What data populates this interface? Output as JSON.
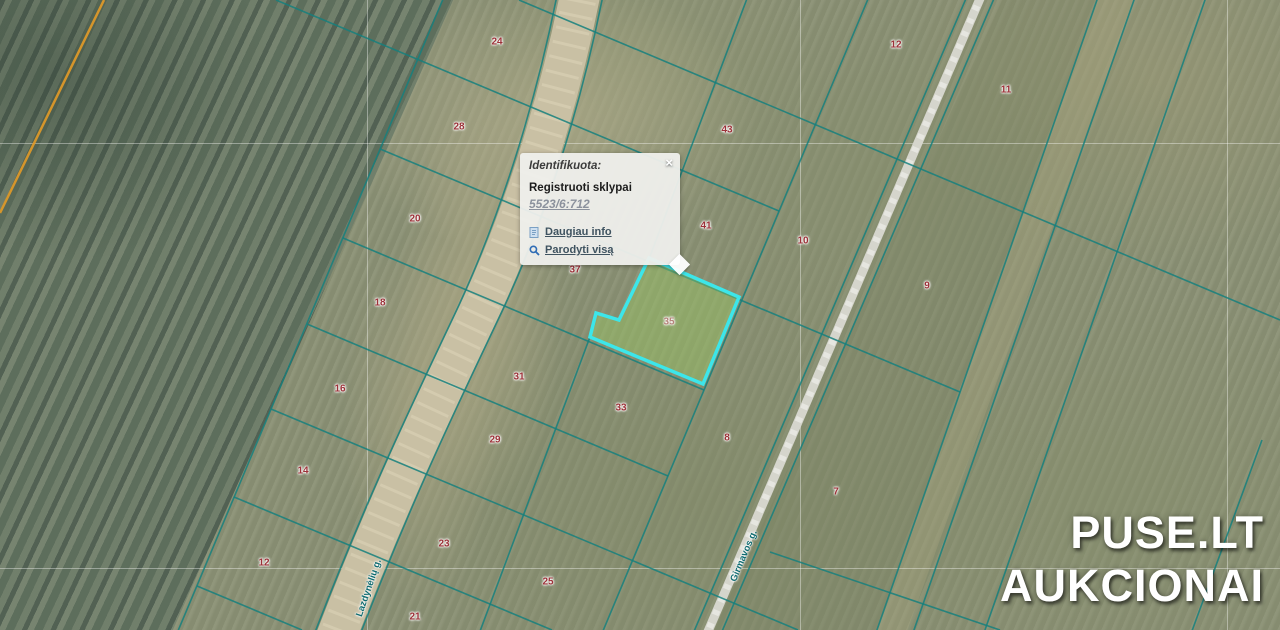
{
  "map": {
    "popup": {
      "title": "Identifikuota:",
      "close_glyph": "×",
      "section_title": "Registruoti sklypai",
      "parcel_link": "5523/6:712",
      "links": [
        {
          "icon": "info-page-icon",
          "label": "Daugiau info"
        },
        {
          "icon": "magnifier-icon",
          "label": "Parodyti visą"
        }
      ]
    },
    "street_labels": [
      {
        "name": "Lazdynėlių g."
      },
      {
        "name": "Girmavos g."
      }
    ],
    "parcel_numbers": [
      {
        "n": "24",
        "x": 497,
        "y": 42
      },
      {
        "n": "12",
        "x": 896,
        "y": 45
      },
      {
        "n": "11",
        "x": 1006,
        "y": 90
      },
      {
        "n": "28",
        "x": 459,
        "y": 127
      },
      {
        "n": "43",
        "x": 727,
        "y": 130
      },
      {
        "n": "20",
        "x": 415,
        "y": 219
      },
      {
        "n": "41",
        "x": 706,
        "y": 226
      },
      {
        "n": "10",
        "x": 803,
        "y": 241
      },
      {
        "n": "37",
        "x": 575,
        "y": 270
      },
      {
        "n": "9",
        "x": 927,
        "y": 286
      },
      {
        "n": "18",
        "x": 380,
        "y": 303
      },
      {
        "n": "35",
        "x": 669,
        "y": 322,
        "hl": true
      },
      {
        "n": "31",
        "x": 519,
        "y": 377
      },
      {
        "n": "16",
        "x": 340,
        "y": 389
      },
      {
        "n": "33",
        "x": 621,
        "y": 408
      },
      {
        "n": "8",
        "x": 727,
        "y": 438
      },
      {
        "n": "29",
        "x": 495,
        "y": 440
      },
      {
        "n": "14",
        "x": 303,
        "y": 471
      },
      {
        "n": "7",
        "x": 836,
        "y": 492
      },
      {
        "n": "23",
        "x": 444,
        "y": 544
      },
      {
        "n": "12",
        "x": 264,
        "y": 563
      },
      {
        "n": "25",
        "x": 548,
        "y": 582
      },
      {
        "n": "21",
        "x": 415,
        "y": 617
      }
    ],
    "watermark": {
      "line1": "PUSE.LT",
      "line2": "AUKCIONAI"
    },
    "colors": {
      "parcel_line": "#15807e",
      "highlight_outline": "#3ce6ea",
      "highlight_fill": "rgba(154,205,98,0.40)",
      "number": "#9c3138",
      "number_highlighted": "#b5837a",
      "street_label": "#0f6b70",
      "orange_line": "#e39b28",
      "road_fill": "#c9c0a4",
      "gravel_road": "#d5d5cc",
      "grid": "rgba(255,255,255,0.38)"
    }
  }
}
